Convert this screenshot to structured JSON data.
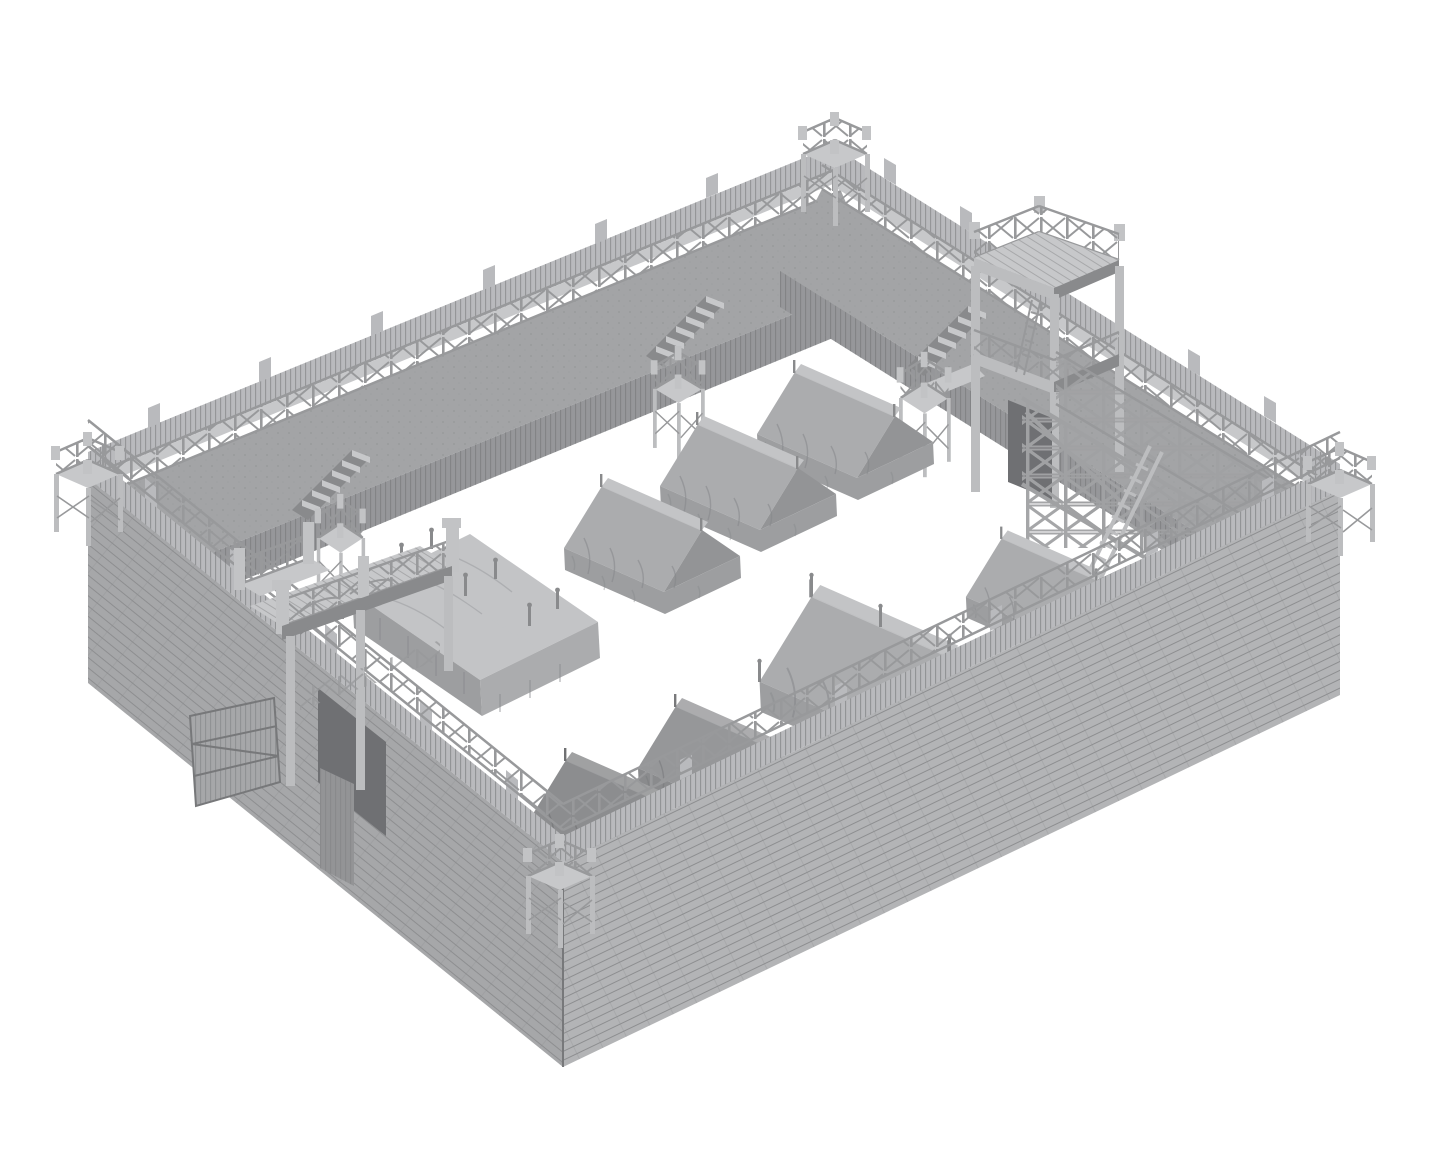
{
  "scene": {
    "type": "3d-product-render",
    "subject": "Wooden palisade fort (Roman marching camp) tabletop terrain model with courtyard tents",
    "style": "monochrome unpainted 3D-print render, isometric view on plain white background",
    "description": "Grayscale 3D render of a rectangular timber fort: plank outer walls with parapet walkway and cross-braced railings, four corner watchtowers, a two-storey gatehouse tower on the far wall and a gatehouse bridge with open gate door on the near wall, earthen rampart with stairs and landing towers inside, truss scaffold ramp with ladder at the right, and a courtyard filled with draped ridge tents, a large marquee, an awning tent and a flat-roofed command pavilion.",
    "background": "#ffffff"
  },
  "palette": {
    "bg": "#ffffff",
    "deck": "#c7c8ca",
    "wallSW": "#a6a7a9",
    "wallSE": "#b3b4b6",
    "plankLine": "#8d8e90",
    "parapet": "#b9babd",
    "palisade": "#96979a",
    "palisadeLine": "#7d7e80",
    "rampart": "#a3a4a6",
    "earthDot": "#8a8b8d",
    "rail": "#98999b",
    "railLight": "#c2c3c5",
    "post": "#bcbdbf",
    "postDark": "#898a8c",
    "shadow": "#6f7073",
    "tentLight": "#c3c4c6",
    "tentMid": "#abacae",
    "tentDark": "#939496",
    "tentSkirt": "#9d9ea0",
    "tentFold": "#85868a",
    "truss": "#a0a1a3",
    "edge": "#77787a"
  },
  "objects": [
    {
      "name": "plank-perimeter-wall",
      "count": 4
    },
    {
      "name": "parapet-walkway-with-cross-railing",
      "count": 4
    },
    {
      "name": "corner-watchtower",
      "count": 4
    },
    {
      "name": "gatehouse-tower-two-storey",
      "count": 1
    },
    {
      "name": "gatehouse-bridge-deck",
      "count": 1
    },
    {
      "name": "open-gate-door",
      "count": 2
    },
    {
      "name": "rampart-stairs",
      "count": 3
    },
    {
      "name": "interior-landing-tower",
      "count": 3
    },
    {
      "name": "truss-scaffold-ramp",
      "count": 1
    },
    {
      "name": "ladder",
      "count": 1
    },
    {
      "name": "ridge-tent",
      "count": 5
    },
    {
      "name": "marquee-tent",
      "count": 1
    },
    {
      "name": "awning-tent",
      "count": 1
    },
    {
      "name": "flat-roof-pavilion",
      "count": 1
    }
  ]
}
